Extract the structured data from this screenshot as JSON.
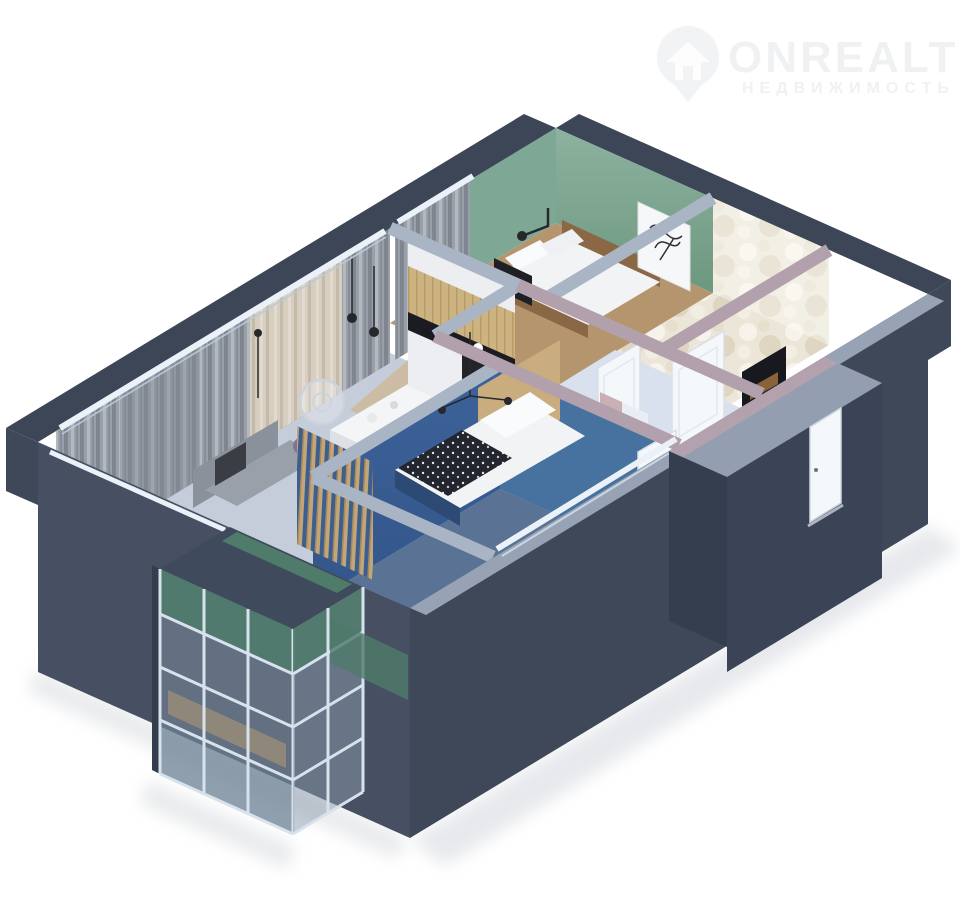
{
  "watermark": {
    "brand": "ONREALT",
    "subtitle": "НЕДВИЖИМОСТЬ",
    "icon": "location-pin-house-icon",
    "color": "#eff1f3"
  },
  "scene": {
    "type": "3d-floorplan-cutaway-render",
    "view": "isometric",
    "background": "#ffffff"
  },
  "palette": {
    "navy_band": "#3c4657",
    "exterior_dark": "#3e4859",
    "exterior_darker": "#343e4f",
    "exterior_light": "#465062",
    "wall_top_light": "#a9b4c4",
    "wall_top_front": "#97a2b4",
    "wall_top_mauve": "#b2a0ac",
    "green_wall": "#7ea795",
    "green_wall_dark": "#6d977f",
    "green_teal": "#4f7b6a",
    "blue_wall": "#3c639a",
    "blue_wall_light": "#47719f",
    "blue_floor": "#5a7294",
    "hall_wall": "#ccd8e8",
    "hall_floor": "#d3dce9",
    "hall_floor_up": "#d8e1ed",
    "marble_floor": "#e9e2d3",
    "floor_living": "#c6cdda",
    "floor_wood_green": "#b5956e",
    "wood_cabinet": "#cdb382",
    "wood_dark": "#8a6846",
    "slat_wood": "#c2a678",
    "curtain_gray": "#979ca5",
    "curtain_beige": "#d5ccbe",
    "sofa_gray": "#9aa0aa",
    "chair_purple": "#837198",
    "counter_black": "#1b1c21",
    "door_white": "#f5f8fb",
    "rail_white": "#eaf1f8",
    "glass_frame": "#d8e2ec",
    "niche_dark": "#17191e",
    "art_green": "#5d8a6a",
    "lamp_black": "#26282c",
    "shadow": "#d3d7dc"
  },
  "rooms": [
    {
      "id": "living-room",
      "features": "windows with gray and beige curtains, gray sofa, white dining table, purple chairs, round glass coffee table, black pendant lamps"
    },
    {
      "id": "kitchen",
      "features": "white tall cabinets, wood upper cabinets, black countertop, black oven"
    },
    {
      "id": "bedroom-green",
      "features": "green walls, wood bed with white bedding, black wall lamp, white nightstand, botanical wall art"
    },
    {
      "id": "bathroom",
      "features": "white marble tiled walls and floor"
    },
    {
      "id": "hallway",
      "features": "light blue walls, two white doors, dark wardrobe niche with wood shelf, green abstract wall art"
    },
    {
      "id": "bedroom-blue",
      "features": "blue walls, bed with white pillow and patterned dark throw, wood headboard, wood slat partition, black pendant"
    },
    {
      "id": "balcony",
      "features": "glazed glass grid walls, teal green back wall, wood floor"
    },
    {
      "id": "entrance",
      "features": "white entry door on dark navy exterior wall"
    }
  ]
}
